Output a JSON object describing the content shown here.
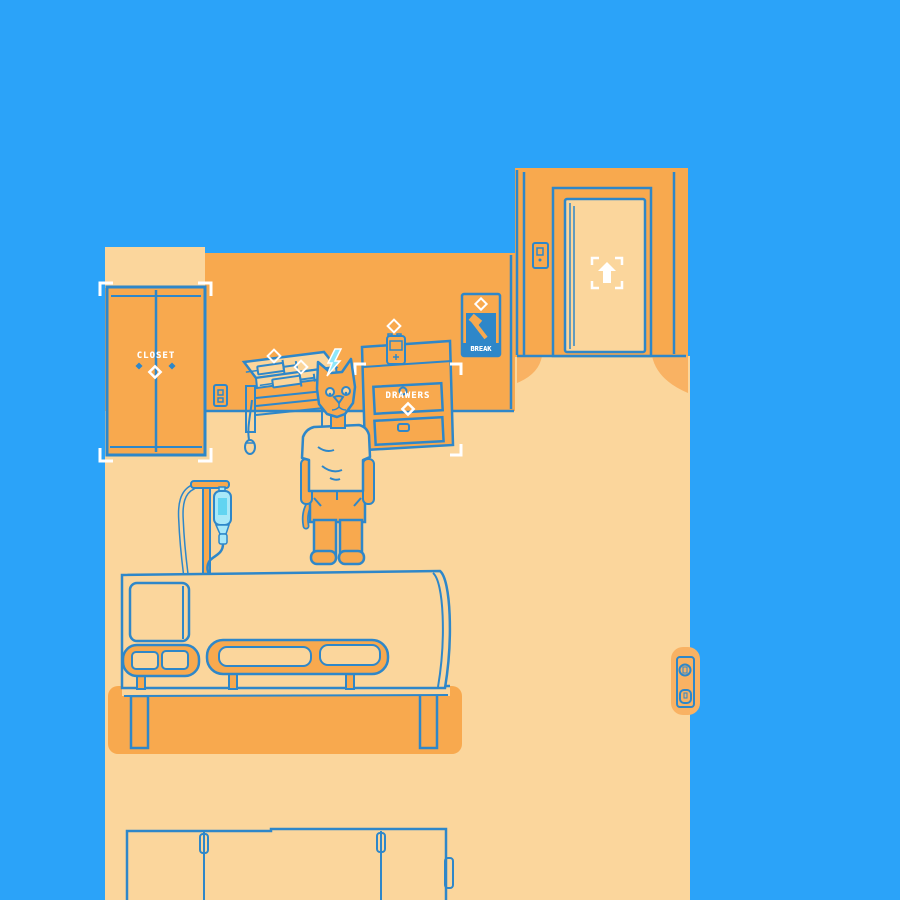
{
  "scene": {
    "description": "point-and-click hospital bedroom scene",
    "palette": {
      "background": "#2BA3F9",
      "outline": "#2E87C9",
      "wall": "#F8A94E",
      "floor": "#FBD69C",
      "soft_shadow": "#F9B263",
      "iv_fluid": "#A8E8F8",
      "iv_fluid_deep": "#62D4F1",
      "spark_cyan": "#8FE7FA",
      "ui_white": "#FFFFFF"
    }
  },
  "labels": {
    "closet": "CLOSET",
    "drawers": "DRAWERS",
    "break_box": "BREAK"
  },
  "icons": {
    "exit_door": "up-arrow-in-corner-brackets",
    "interact_hint": "hollow-diamond-sparkle",
    "selection_frame": "white-corner-brackets",
    "thought_indicator": "lightning-bolt",
    "label_marker": "white-diamond",
    "door_handle": "blue-diamond"
  }
}
